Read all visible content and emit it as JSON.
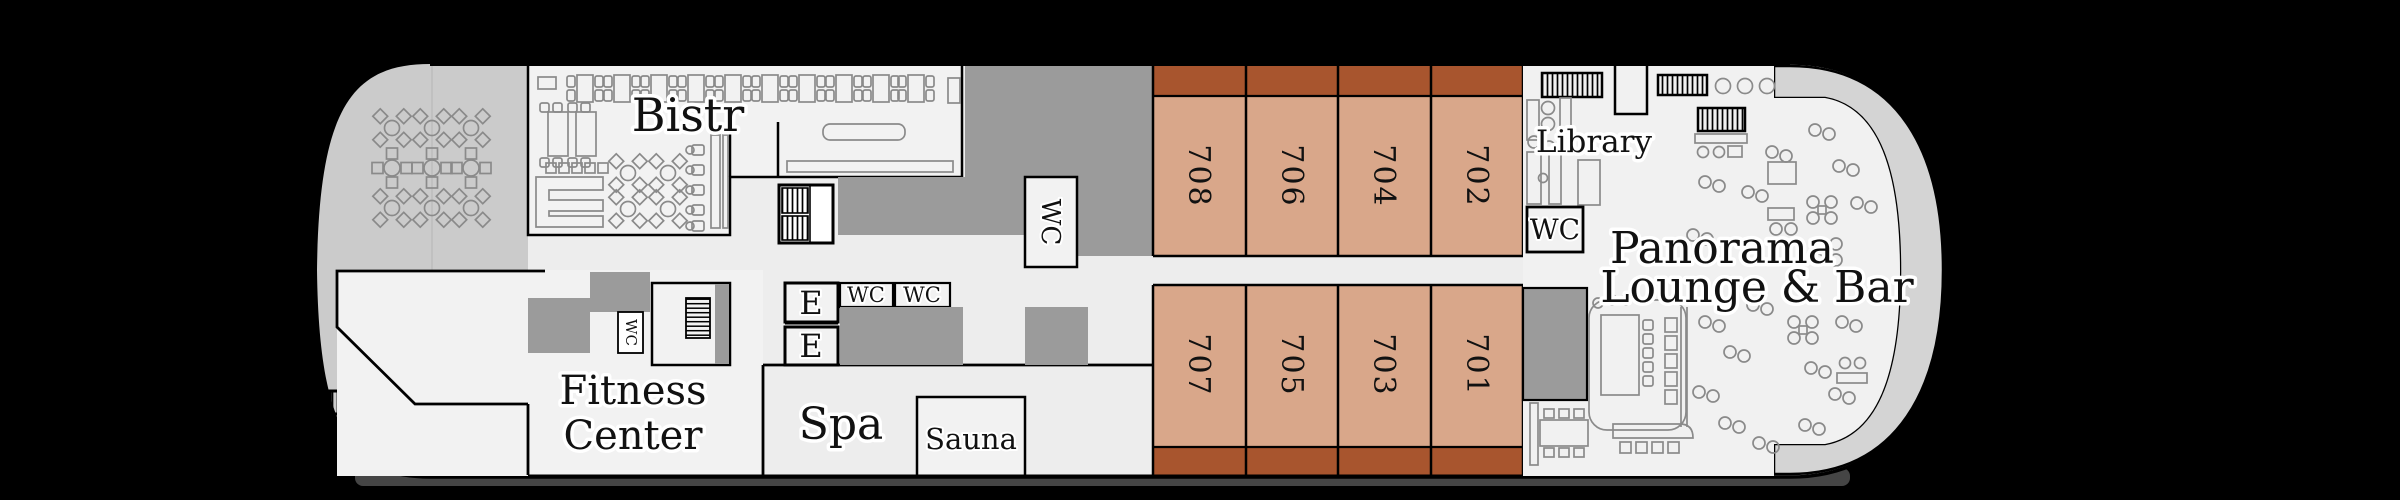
{
  "plan": {
    "type": "cruise-ship-deck-plan",
    "labels": {
      "bistro": "Bistr",
      "library": "Library",
      "lounge_line1": "Panorama",
      "lounge_line2": "Lounge & Bar",
      "fitness_line1": "Fitness",
      "fitness_line2": "Center",
      "spa": "Spa",
      "sauna": "Sauna",
      "wc": "WC",
      "elevator": "E"
    },
    "cabins": {
      "upper": [
        {
          "number": "708"
        },
        {
          "number": "706"
        },
        {
          "number": "704"
        },
        {
          "number": "702"
        }
      ],
      "lower": [
        {
          "number": "707"
        },
        {
          "number": "705"
        },
        {
          "number": "703"
        },
        {
          "number": "701"
        }
      ]
    },
    "colors": {
      "background": "#000000",
      "interior": "#ededed",
      "room_fill": "#f2f2f2",
      "bow_deck": "#cbcbcb",
      "stern_promenade": "#d4d4d4",
      "service_block": "#9b9b9b",
      "cabin_fill": "#d9a78a",
      "balcony_fill": "#a8552e",
      "outline": "#000000",
      "furniture_outline": "#8a8a8a",
      "hull_shadow": "#454545"
    },
    "icons": {
      "stairs": "hatched-stairs-icon",
      "elevator_box": "elevator-icon",
      "round_table_four_chairs": "flower-table-icon",
      "dining_table_pair": "table-two-chairs-icon",
      "bar_counter": "bar-counter-icon"
    }
  }
}
